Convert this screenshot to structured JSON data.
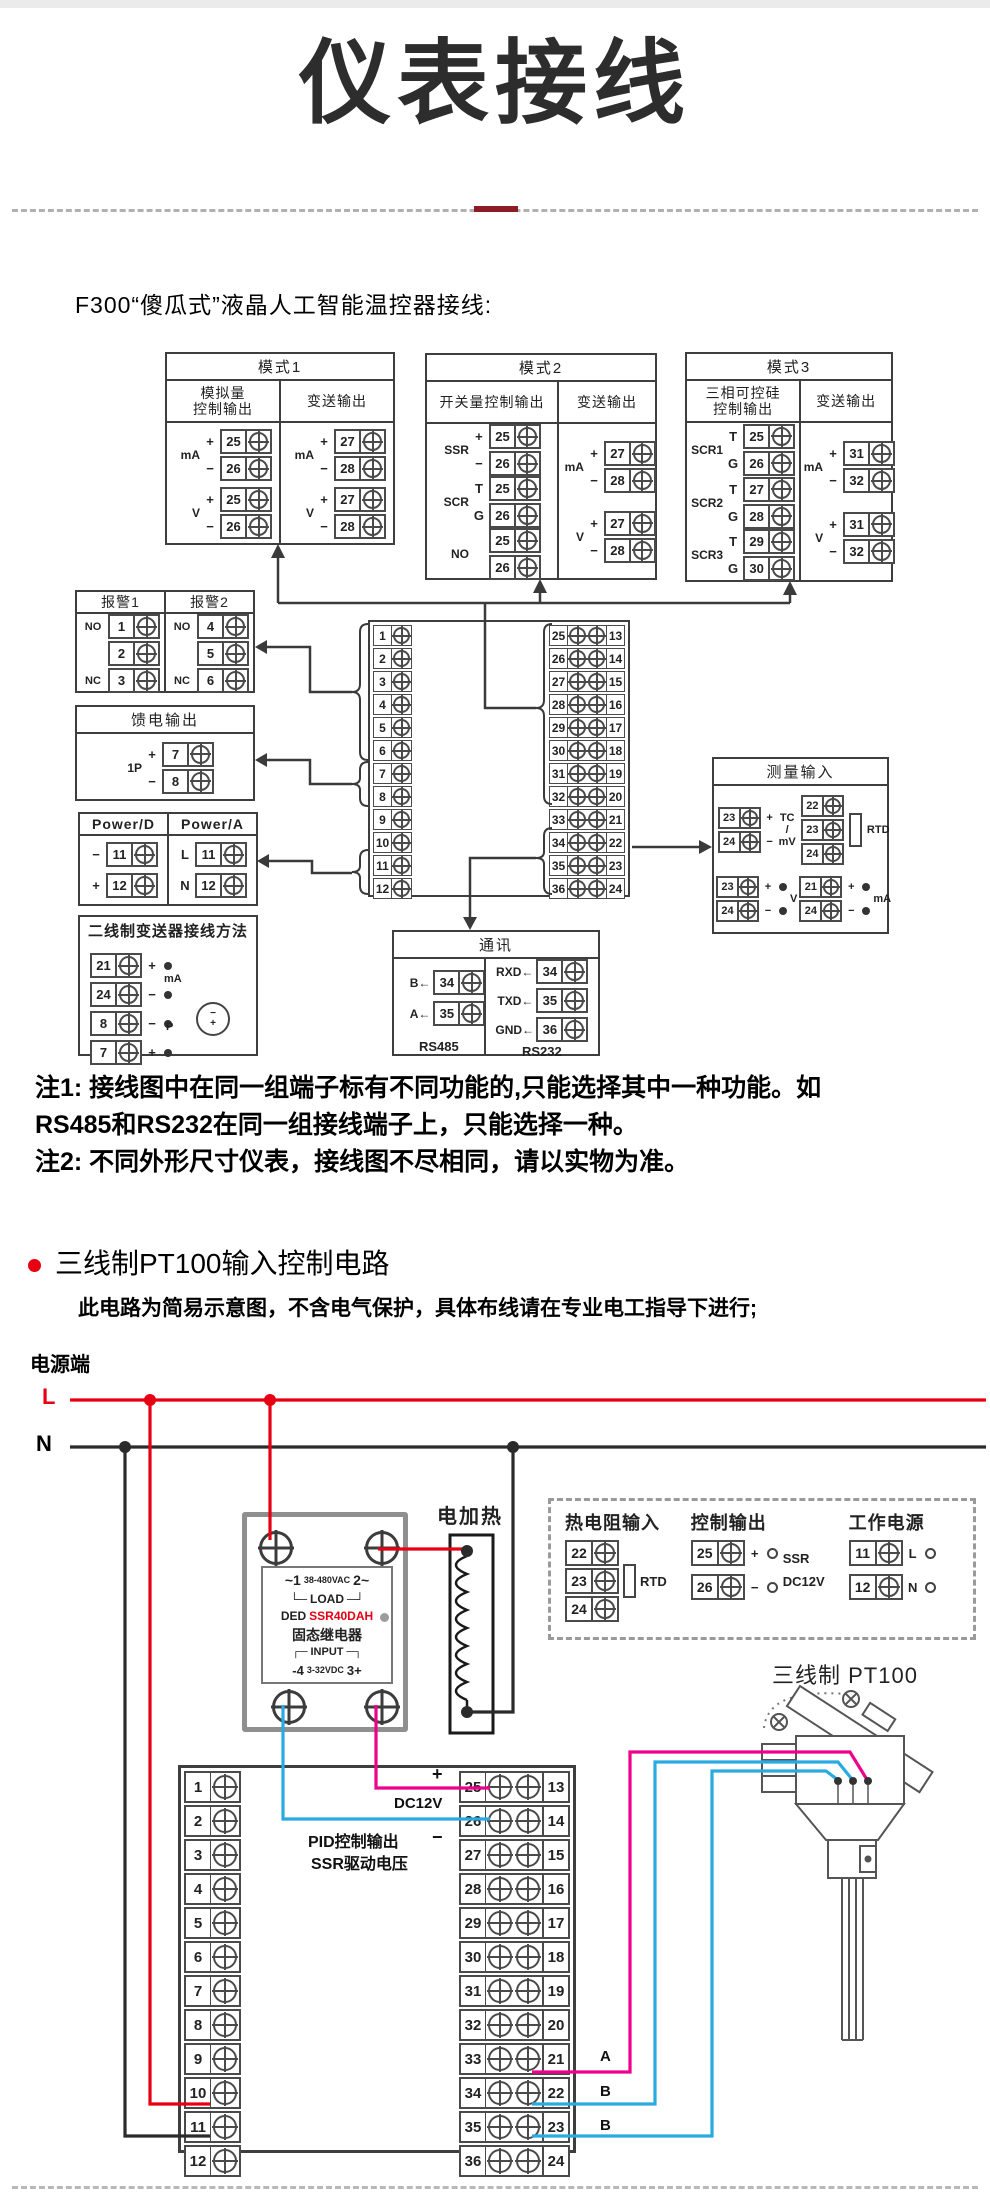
{
  "header": {
    "title": "仪表接线",
    "section1_heading": "F300“傻瓜式”液晶人工智能温控器接线:"
  },
  "mode1": {
    "title": "模式1",
    "h1a": "模拟量",
    "h1b": "控制输出",
    "h2": "变送输出",
    "a": [
      {
        "label": "mA",
        "rows": [
          {
            "sign": "+",
            "num": "25"
          },
          {
            "sign": "−",
            "num": "26"
          }
        ]
      },
      {
        "label": "V",
        "rows": [
          {
            "sign": "+",
            "num": "25"
          },
          {
            "sign": "−",
            "num": "26"
          }
        ]
      }
    ],
    "b": [
      {
        "label": "mA",
        "rows": [
          {
            "sign": "+",
            "num": "27"
          },
          {
            "sign": "−",
            "num": "28"
          }
        ]
      },
      {
        "label": "V",
        "rows": [
          {
            "sign": "+",
            "num": "27"
          },
          {
            "sign": "−",
            "num": "28"
          }
        ]
      }
    ]
  },
  "mode2": {
    "title": "模式2",
    "h1a": "开关量控制输出",
    "h1b": "",
    "h2": "变送输出",
    "a": [
      {
        "label": "SSR",
        "rows": [
          {
            "sign": "+",
            "num": "25"
          },
          {
            "sign": "−",
            "num": "26"
          }
        ]
      },
      {
        "label": "SCR",
        "rows": [
          {
            "sign": "T",
            "num": "25"
          },
          {
            "sign": "G",
            "num": "26"
          }
        ]
      },
      {
        "label": "NO",
        "rows": [
          {
            "sign": "",
            "num": "25"
          },
          {
            "sign": "",
            "num": "26"
          }
        ]
      }
    ],
    "b": [
      {
        "label": "mA",
        "rows": [
          {
            "sign": "+",
            "num": "27"
          },
          {
            "sign": "−",
            "num": "28"
          }
        ]
      },
      {
        "label": "V",
        "rows": [
          {
            "sign": "+",
            "num": "27"
          },
          {
            "sign": "−",
            "num": "28"
          }
        ]
      }
    ]
  },
  "mode3": {
    "title": "模式3",
    "h1a": "三相可控硅",
    "h1b": "控制输出",
    "h2": "变送输出",
    "a": [
      {
        "label": "SCR1",
        "rows": [
          {
            "sign": "T",
            "num": "25"
          },
          {
            "sign": "G",
            "num": "26"
          }
        ]
      },
      {
        "label": "SCR2",
        "rows": [
          {
            "sign": "T",
            "num": "27"
          },
          {
            "sign": "G",
            "num": "28"
          }
        ]
      },
      {
        "label": "SCR3",
        "rows": [
          {
            "sign": "T",
            "num": "29"
          },
          {
            "sign": "G",
            "num": "30"
          }
        ]
      }
    ],
    "b": [
      {
        "label": "mA",
        "rows": [
          {
            "sign": "+",
            "num": "31"
          },
          {
            "sign": "−",
            "num": "32"
          }
        ]
      },
      {
        "label": "V",
        "rows": [
          {
            "sign": "+",
            "num": "31"
          },
          {
            "sign": "−",
            "num": "32"
          }
        ]
      }
    ]
  },
  "alarm": {
    "t1": "报警1",
    "t2": "报警2",
    "g1": {
      "rows": [
        {
          "sign": "NO",
          "num": "1"
        },
        {
          "sign": "",
          "num": "2"
        },
        {
          "sign": "NC",
          "num": "3"
        }
      ]
    },
    "g2": {
      "rows": [
        {
          "sign": "NO",
          "num": "4"
        },
        {
          "sign": "",
          "num": "5"
        },
        {
          "sign": "NC",
          "num": "6"
        }
      ]
    }
  },
  "feed": {
    "title": "馈电输出",
    "label": "1P",
    "rows": [
      {
        "sign": "+",
        "num": "7"
      },
      {
        "sign": "−",
        "num": "8"
      }
    ]
  },
  "power": {
    "t1": "Power/D",
    "t2": "Power/A",
    "g1": {
      "rows": [
        {
          "sign": "−",
          "num": "11"
        },
        {
          "sign": "+",
          "num": "12"
        }
      ]
    },
    "g2": {
      "rows": [
        {
          "sign": "L",
          "num": "11"
        },
        {
          "sign": "N",
          "num": "12"
        }
      ]
    }
  },
  "twowire": {
    "title": "二线制变送器接线方法",
    "mid1": "mA",
    "mid2": "P",
    "tminus": "−",
    "tplus": "+",
    "rows": [
      {
        "sign": "+",
        "num": "21"
      },
      {
        "sign": "−",
        "num": "24"
      },
      {
        "sign": "−",
        "num": "8"
      },
      {
        "sign": "+",
        "num": "7"
      }
    ]
  },
  "central": {
    "left": [
      "1",
      "2",
      "3",
      "4",
      "5",
      "6",
      "7",
      "8",
      "9",
      "10",
      "11",
      "12"
    ],
    "right": [
      {
        "a": "25",
        "b": "13"
      },
      {
        "a": "26",
        "b": "14"
      },
      {
        "a": "27",
        "b": "15"
      },
      {
        "a": "28",
        "b": "16"
      },
      {
        "a": "29",
        "b": "17"
      },
      {
        "a": "30",
        "b": "18"
      },
      {
        "a": "31",
        "b": "19"
      },
      {
        "a": "32",
        "b": "20"
      },
      {
        "a": "33",
        "b": "21"
      },
      {
        "a": "34",
        "b": "22"
      },
      {
        "a": "35",
        "b": "23"
      },
      {
        "a": "36",
        "b": "24"
      }
    ]
  },
  "measure": {
    "title": "测量输入",
    "tl": {
      "rows": [
        {
          "sign": "+",
          "num": "23"
        },
        {
          "sign": "−",
          "num": "24"
        }
      ],
      "l1": "TC",
      "l2": "/",
      "l3": "mV"
    },
    "tr": {
      "rows": [
        {
          "sign": "",
          "num": "22"
        },
        {
          "sign": "",
          "num": "23"
        },
        {
          "sign": "",
          "num": "24"
        }
      ],
      "label": "RTD"
    },
    "bl": {
      "rows": [
        {
          "sign": "+",
          "num": "23"
        },
        {
          "sign": "−",
          "num": "24"
        }
      ],
      "label": "V"
    },
    "br": {
      "rows": [
        {
          "sign": "+",
          "num": "21"
        },
        {
          "sign": "−",
          "num": "24"
        }
      ],
      "label": "mA"
    }
  },
  "comm": {
    "title": "通讯",
    "c1": {
      "rows": [
        {
          "sign": "B←",
          "num": "34"
        },
        {
          "sign": "A←",
          "num": "35"
        }
      ],
      "caption": "RS485"
    },
    "c2": {
      "rows": [
        {
          "sign": "RXD←",
          "num": "34"
        },
        {
          "sign": "TXD←",
          "num": "35"
        },
        {
          "sign": "GND←",
          "num": "36"
        }
      ],
      "caption": "RS232"
    }
  },
  "notes": {
    "n1a": "注1: 接线图中在同一组端子标有不同功能的,只能选择其中一种功能。如",
    "n1b": "RS485和RS232在同一组接线端子上，只能选择一种。",
    "n2": "注2: 不同外形尺寸仪表，接线图不尽相同，请以实物为准。"
  },
  "section2": {
    "title": "三线制PT100输入控制电路",
    "subtitle": "此电路为简易示意图，不含电气保护，具体布线请在专业电工指导下进行;",
    "power_terminal": "电源端",
    "l": "L",
    "n": "N",
    "heater": "电加热",
    "pt100": "三线制 PT100"
  },
  "ssr": {
    "l1a": "~1",
    "l1b": "38-480VAC",
    "l1c": "2~",
    "l2a": "└─",
    "l2b": "LOAD",
    "l2c": "─┘",
    "l3a": "DED",
    "l3b": "SSR40DAH",
    "l4": "固态继电器",
    "l5a": "┌─",
    "l5b": "INPUT",
    "l5c": "─┐",
    "l6a": "-4",
    "l6b": "3-32VDC",
    "l6c": "3+"
  },
  "dashedbox": {
    "g1": {
      "title": "热电阻输入",
      "rows": [
        {
          "sign": "",
          "num": "22"
        },
        {
          "sign": "",
          "num": "23"
        },
        {
          "sign": "",
          "num": "24"
        }
      ],
      "label": "RTD"
    },
    "g2": {
      "title": "控制输出",
      "rows": [
        {
          "sign": "+",
          "num": "25"
        },
        {
          "sign": "−",
          "num": "26"
        }
      ],
      "lbl1": "SSR",
      "lbl2": "DC12V"
    },
    "g3": {
      "title": "工作电源",
      "rows": [
        {
          "sign": "L",
          "num": "11"
        },
        {
          "sign": "N",
          "num": "12"
        }
      ]
    }
  },
  "bottomblock": {
    "left": [
      "1",
      "2",
      "3",
      "4",
      "5",
      "6",
      "7",
      "8",
      "9",
      "10",
      "11",
      "12"
    ],
    "right": [
      {
        "a": "25",
        "b": "13"
      },
      {
        "a": "26",
        "b": "14"
      },
      {
        "a": "27",
        "b": "15"
      },
      {
        "a": "28",
        "b": "16"
      },
      {
        "a": "29",
        "b": "17"
      },
      {
        "a": "30",
        "b": "18"
      },
      {
        "a": "31",
        "b": "19"
      },
      {
        "a": "32",
        "b": "20"
      },
      {
        "a": "33",
        "b": "21"
      },
      {
        "a": "34",
        "b": "22"
      },
      {
        "a": "35",
        "b": "23"
      },
      {
        "a": "36",
        "b": "24"
      }
    ]
  },
  "wirelabels": {
    "plus": "+",
    "dc12v": "DC12V",
    "minus": "−",
    "pid1": "PID控制输出",
    "pid2": "SSR驱动电压",
    "a": "A",
    "b1": "B",
    "b2": "B"
  },
  "colors": {
    "accent_red": "#e60012",
    "wire_blue": "#29abe2",
    "wire_magenta": "#ec008c",
    "line_dark": "#3a3a3a"
  }
}
